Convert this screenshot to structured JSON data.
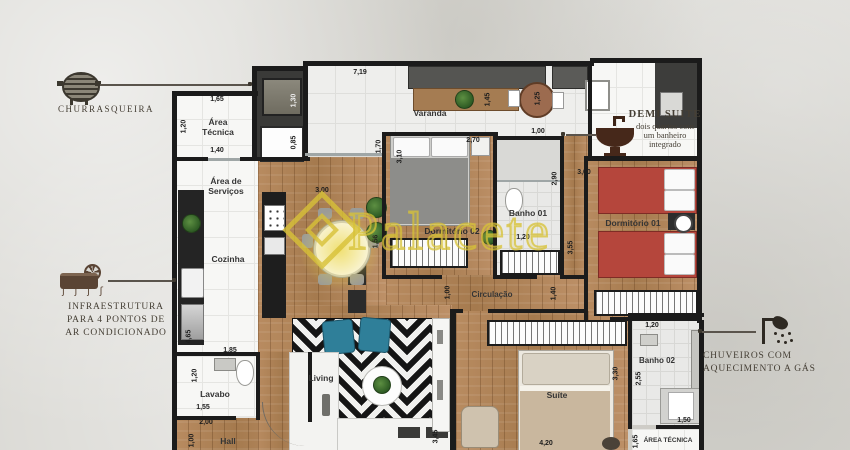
{
  "watermark": {
    "text": "Palacete",
    "color": "#d7c137"
  },
  "annotations": {
    "churrasqueira": {
      "icon": "grill-icon",
      "label": "CHURRASQUEIRA"
    },
    "demi_suite": {
      "icon": "sink-icon",
      "title": "DEMI SUITE",
      "lines": [
        "dois quartos com",
        "um banheiro",
        "integrado"
      ]
    },
    "ar_condicionado": {
      "icon": "ac-unit-icon",
      "lines": [
        "INFRAESTRUTURA",
        "PARA 4 PONTOS DE",
        "AR CONDICIONADO"
      ],
      "airflow_glyphs": "ʃ ʃ ʃ ʃ"
    },
    "chuveiros": {
      "icon": "shower-icon",
      "lines": [
        "CHUVEIROS COM",
        "AQUECIMENTO A GÁS"
      ]
    }
  },
  "rooms": {
    "area_tecnica_sup": {
      "lines": [
        "Área",
        "Técnica"
      ]
    },
    "varanda": {
      "label": "Varanda"
    },
    "area_servicos": {
      "lines": [
        "Área de",
        "Serviços"
      ]
    },
    "cozinha": {
      "label": "Cozinha"
    },
    "banho_01": {
      "label": "Banho 01"
    },
    "dormitorio_01": {
      "label": "Dormitório 01"
    },
    "dormitorio_02": {
      "label": "Dormitório 02"
    },
    "circulacao": {
      "label": "Circulação"
    },
    "living": {
      "label": "Living"
    },
    "lavabo": {
      "label": "Lavabo"
    },
    "hall": {
      "label": "Hall"
    },
    "suite": {
      "label": "Suíte"
    },
    "banho_02": {
      "label": "Banho 02"
    },
    "area_tecnica_inf": {
      "label": "ÁREA TÉCNICA"
    }
  },
  "dimensions": [
    {
      "v": "1,65"
    },
    {
      "v": "1,20"
    },
    {
      "v": "1,40"
    },
    {
      "v": "1,30"
    },
    {
      "v": "0,85"
    },
    {
      "v": "7,19"
    },
    {
      "v": "1,45"
    },
    {
      "v": "1,25"
    },
    {
      "v": "1,00"
    },
    {
      "v": "2,90"
    },
    {
      "v": "3,00"
    },
    {
      "v": "1,70"
    },
    {
      "v": "3,10"
    },
    {
      "v": "2,70"
    },
    {
      "v": "3,00"
    },
    {
      "v": "1,56"
    },
    {
      "v": "3,55"
    },
    {
      "v": "1,00"
    },
    {
      "v": "1,40"
    },
    {
      "v": "1,20"
    },
    {
      "v": "2,55"
    },
    {
      "v": "3,30"
    },
    {
      "v": "1,50"
    },
    {
      "v": "1,65"
    },
    {
      "v": "4,20"
    },
    {
      "v": "3,45"
    },
    {
      "v": "4,65"
    },
    {
      "v": "1,85"
    },
    {
      "v": "1,20"
    },
    {
      "v": "1,55"
    },
    {
      "v": "2,00"
    },
    {
      "v": "1,00"
    },
    {
      "v": "1,20"
    }
  ],
  "colors": {
    "wall": "#1b1b1b",
    "wood": "#b1855a",
    "bed_red": "#b5463c",
    "chair_blue": "#2f7f99"
  }
}
